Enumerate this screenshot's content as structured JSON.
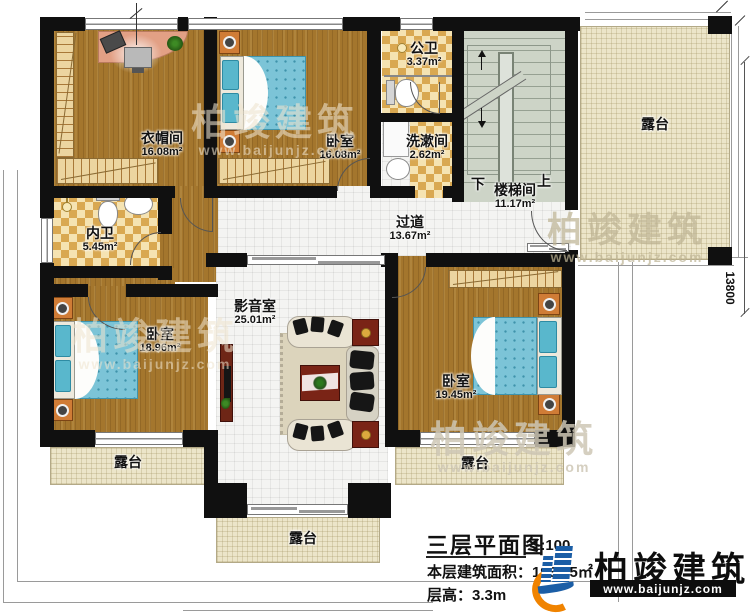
{
  "plan": {
    "rooms": {
      "cloakroom": {
        "name": "衣帽间",
        "area": "16.08m²"
      },
      "bedroom_top": {
        "name": "卧室",
        "area": "16.08m²"
      },
      "public_bath": {
        "name": "公卫",
        "area": "3.37m²"
      },
      "washroom": {
        "name": "洗漱间",
        "area": "2.62m²"
      },
      "stairwell": {
        "name": "楼梯间",
        "area": "11.17m²",
        "down_label": "下",
        "up_label": "上"
      },
      "inner_bath": {
        "name": "内卫",
        "area": "5.45m²"
      },
      "corridor": {
        "name": "过道",
        "area": "13.67m²"
      },
      "media_room": {
        "name": "影音室",
        "area": "25.01m²"
      },
      "bedroom_left": {
        "name": "卧室",
        "area": "18.96m²"
      },
      "bedroom_right": {
        "name": "卧室",
        "area": "19.45m²"
      }
    },
    "terraces": {
      "right": "露台",
      "bottom_left": "露台",
      "bottom_center": "露台",
      "bottom_right": "露台"
    },
    "dimensions": {
      "right_side": "13800"
    }
  },
  "title_block": {
    "title": "三层平面图",
    "scale": "1:100",
    "floor_area": "本层建筑面积：193.05㎡",
    "floor_height": "层高：3.3m"
  },
  "brand": {
    "name": "柏竣建筑",
    "website": "www.baijunjz.com"
  },
  "watermark": {
    "name": "柏竣建筑",
    "website": "www.baijunjz.com"
  },
  "colors": {
    "wall": "#101010",
    "wood_floor": "#a4762d",
    "terrace": "#ece5c9",
    "checker_tile": "#d9a851",
    "bed_blue": "#7cc4d7",
    "furniture_red": "#7a2416",
    "brand_blue": "#1b5ea6",
    "brand_orange": "#f08300"
  }
}
